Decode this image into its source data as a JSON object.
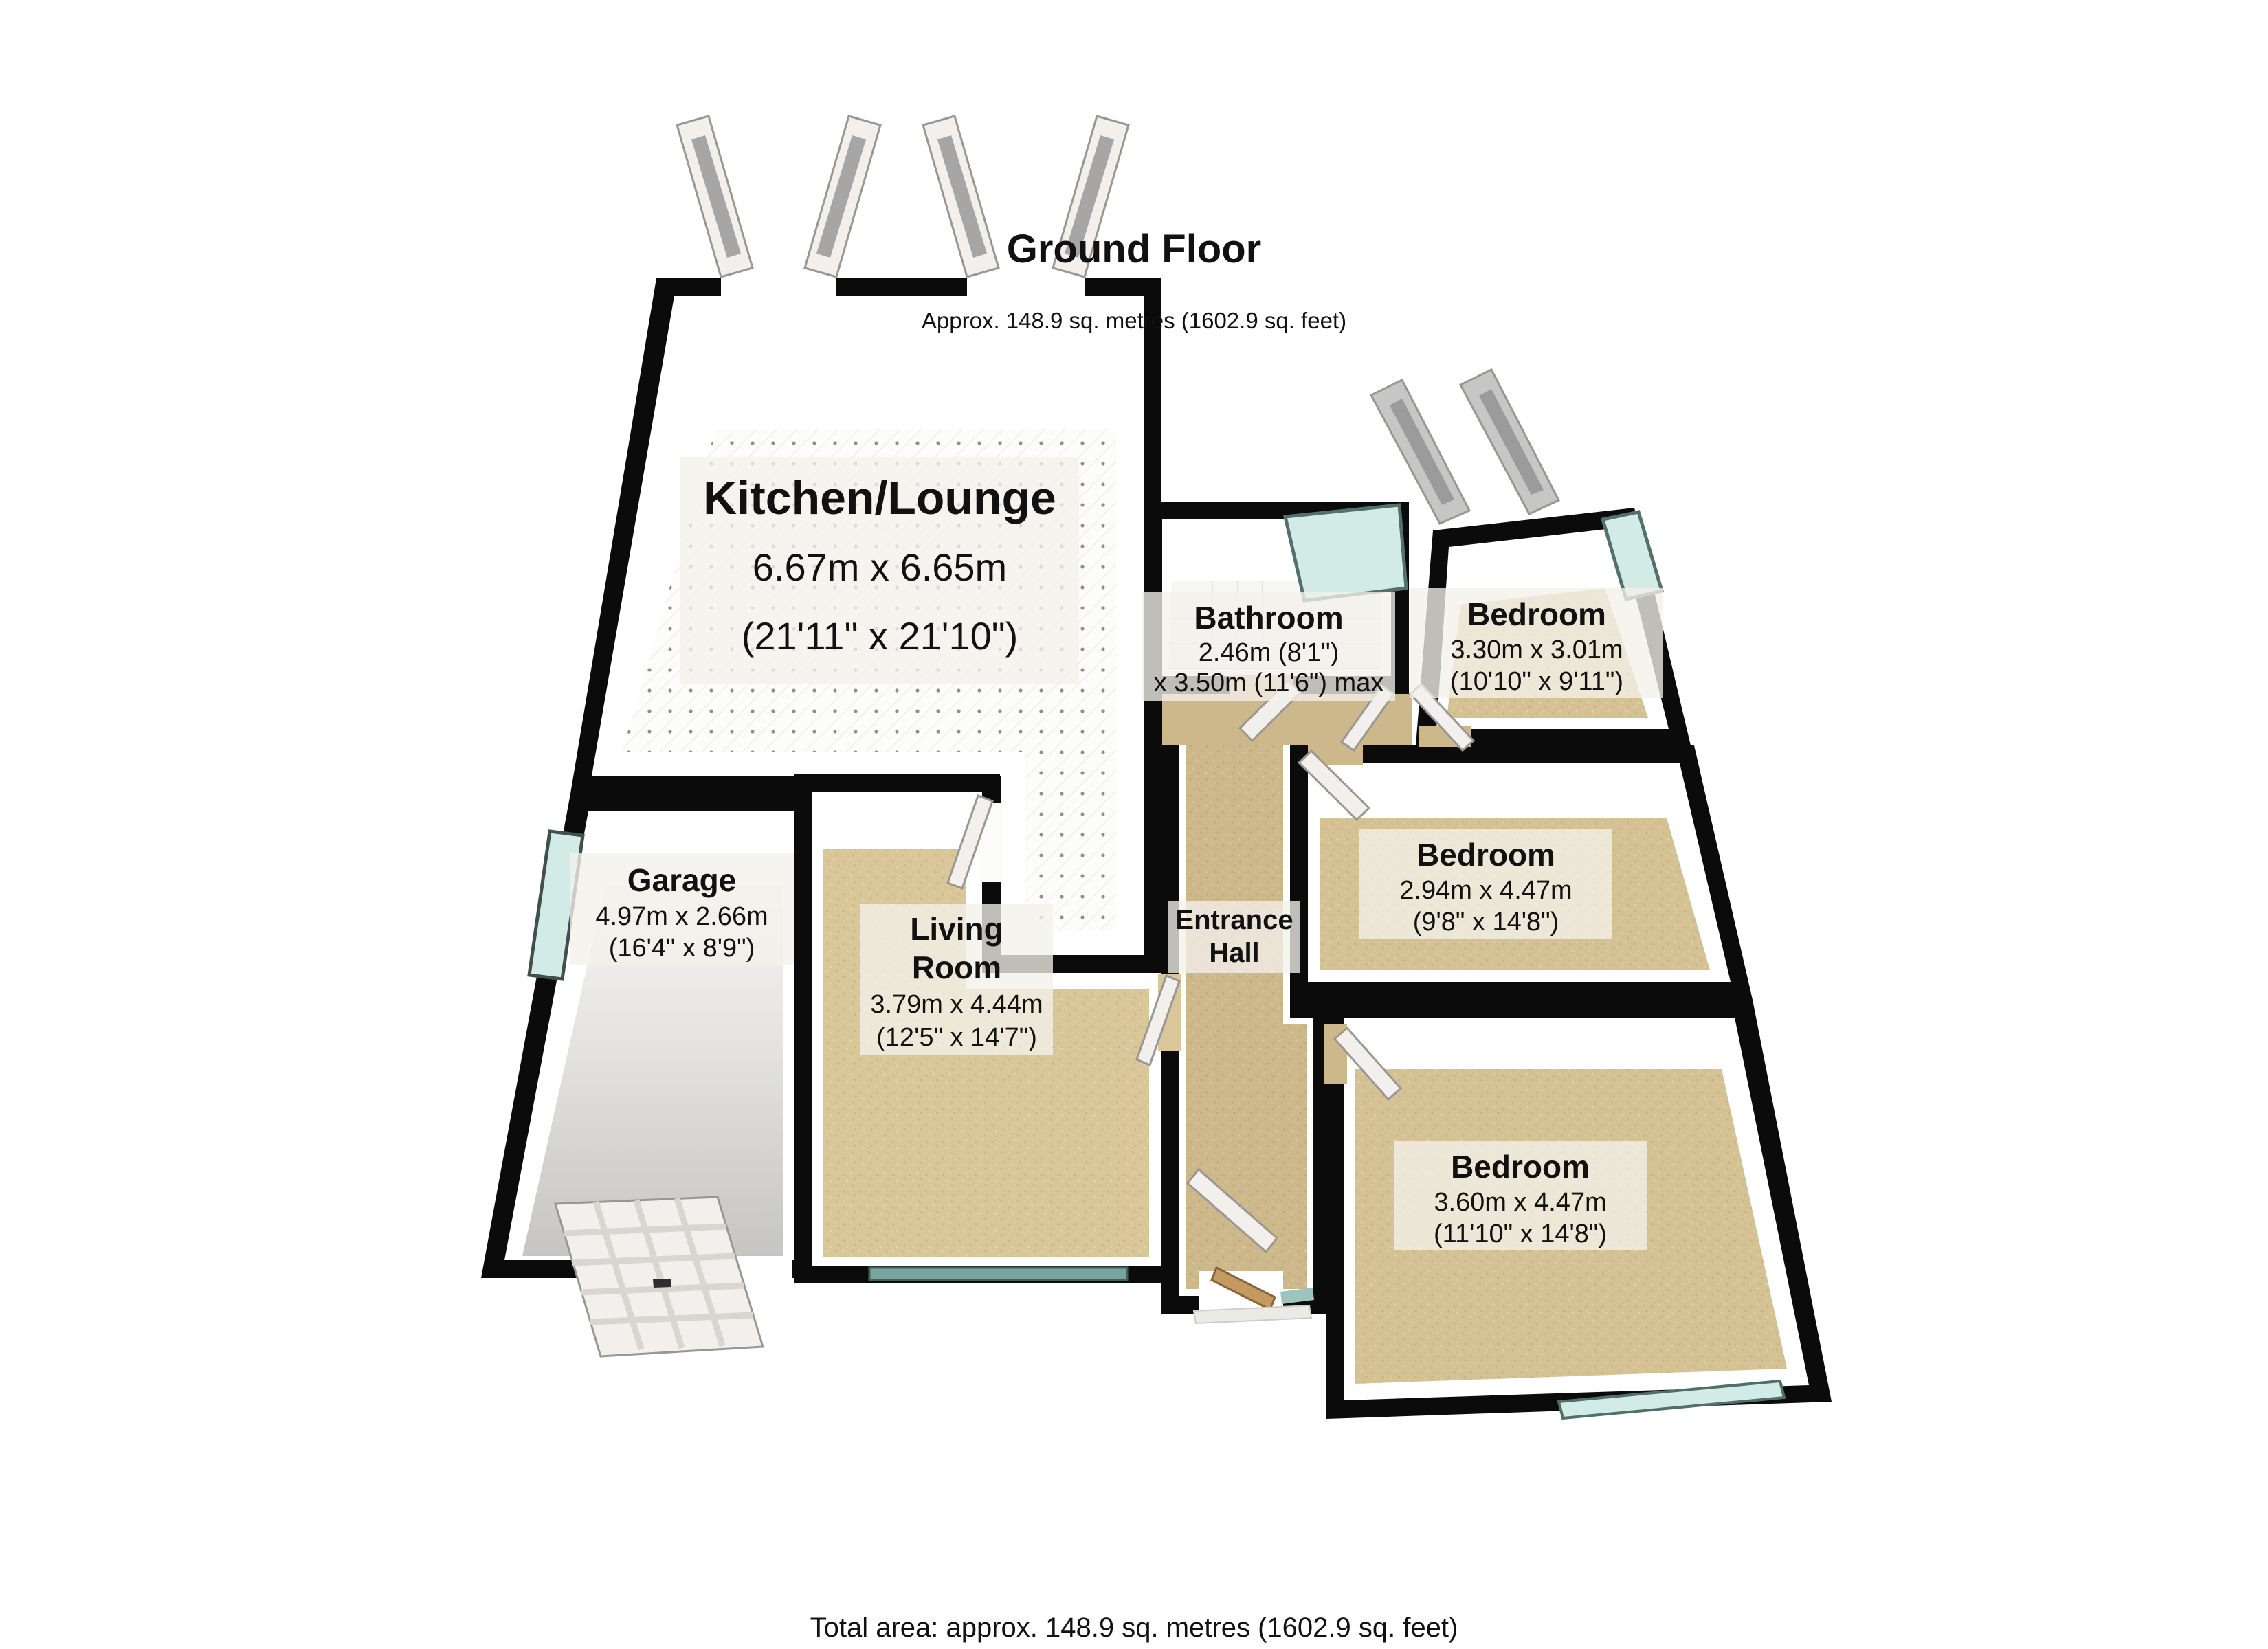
{
  "header": {
    "title": "Ground Floor",
    "subtitle": "Approx. 148.9 sq. metres (1602.9 sq. feet)"
  },
  "footer": {
    "total_area": "Total area: approx. 148.9 sq. metres (1602.9 sq. feet)"
  },
  "colors": {
    "wall": "#0b0b0b",
    "window_glass": "#d3ebe7",
    "window_glass_dark": "#7aa49e",
    "window_glass_side": "#9dc4bf",
    "carpet": "#d5c294",
    "carpet_living": "#d9c79a",
    "carpet_hall": "#cdb88c",
    "kitchen_floor": "#fcfcfb",
    "bathroom_floor": "#f6f6f5",
    "garage_floor": "#d2d1cf",
    "door_white": "#f2efec",
    "door_wood": "#c59a62",
    "porch_step": "#eceae6",
    "label_bg": "#f3f1ea"
  },
  "rooms": {
    "kitchen_lounge": {
      "name": "Kitchen/Lounge",
      "metric": "6.67m x 6.65m",
      "imperial": "(21'11\" x 21'10\")"
    },
    "bathroom": {
      "name": "Bathroom",
      "metric": "2.46m (8'1\")",
      "imperial": "x 3.50m (11'6\") max"
    },
    "bedroom_top": {
      "name": "Bedroom",
      "metric": "3.30m x 3.01m",
      "imperial": "(10'10\" x 9'11\")"
    },
    "bedroom_middle": {
      "name": "Bedroom",
      "metric": "2.94m x 4.47m",
      "imperial": "(9'8\" x 14'8\")"
    },
    "bedroom_bottom": {
      "name": "Bedroom",
      "metric": "3.60m x 4.47m",
      "imperial": "(11'10\" x 14'8\")"
    },
    "garage": {
      "name": "Garage",
      "metric": "4.97m x 2.66m",
      "imperial": "(16'4\" x 8'9\")"
    },
    "living_room": {
      "name_line1": "Living",
      "name_line2": "Room",
      "metric": "3.79m x 4.44m",
      "imperial": "(12'5\" x 14'7\")"
    },
    "entrance_hall": {
      "name_line1": "Entrance",
      "name_line2": "Hall"
    }
  }
}
